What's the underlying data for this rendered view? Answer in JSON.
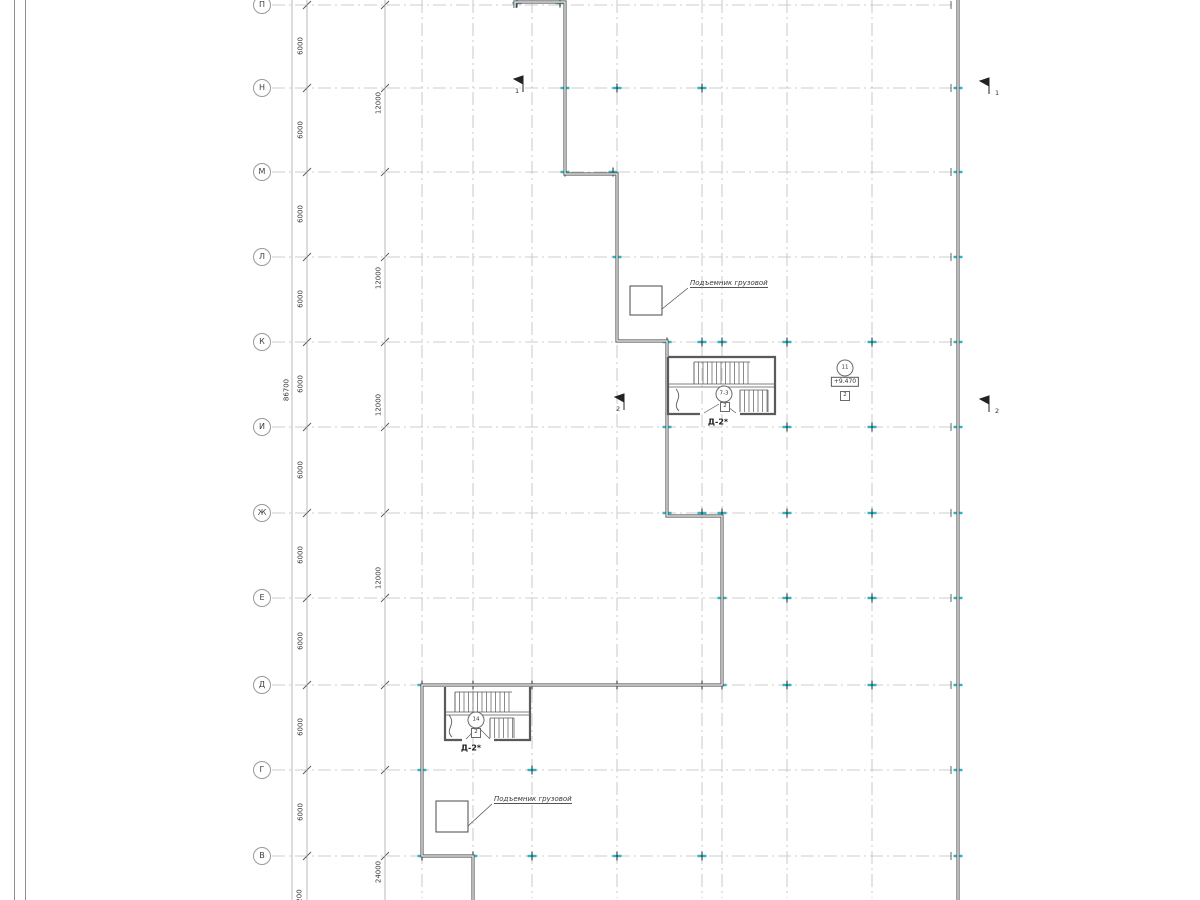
{
  "grid": {
    "row_labels": [
      "П",
      "Н",
      "М",
      "Л",
      "К",
      "И",
      "Ж",
      "Е",
      "Д",
      "Г",
      "В"
    ]
  },
  "dimensions": {
    "span_6000": "6000",
    "span_12000": "12000",
    "span_24000": "24000",
    "total_86700": "86700",
    "partial_200": "200"
  },
  "annotations": {
    "hoist_label": "Подъемник грузовой",
    "stair_tag": "Д-2*",
    "stair1_ref": "7-3",
    "stair2_ref": "14",
    "stair_detail_ref": "2",
    "node_ref": "11",
    "elevation": "+9.470",
    "level_detail_ref": "2",
    "section1": "1",
    "section2": "2"
  },
  "colors": {
    "grid_line": "#bdbdbd",
    "wall": "#606060",
    "column_marker": "#2ab5c0",
    "text": "#3a3a3a"
  }
}
